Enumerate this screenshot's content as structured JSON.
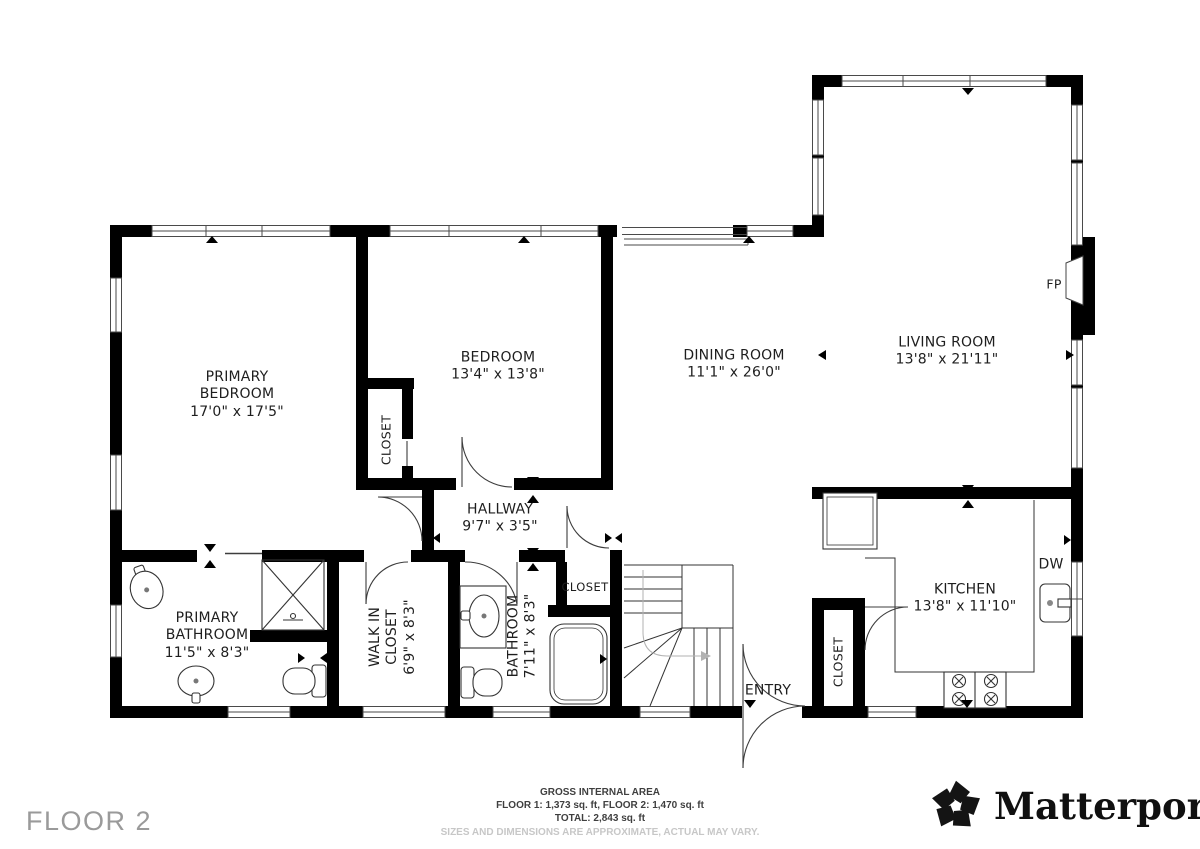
{
  "page": {
    "floor_label": "FLOOR 2"
  },
  "rooms": [
    {
      "name": "PRIMARY BEDROOM",
      "dims": "17'0\" x 17'5\""
    },
    {
      "name": "BEDROOM",
      "dims": "13'4\" x 13'8\""
    },
    {
      "name": "DINING ROOM",
      "dims": "11'1\" x 26'0\""
    },
    {
      "name": "LIVING ROOM",
      "dims": "13'8\" x 21'11\""
    },
    {
      "name": "HALLWAY",
      "dims": "9'7\" x 3'5\""
    },
    {
      "name": "PRIMARY BATHROOM",
      "dims": "11'5\" x 8'3\""
    },
    {
      "name": "WALK IN CLOSET",
      "dims": "6'9\" x 8'3\""
    },
    {
      "name": "BATHROOM",
      "dims": "7'11\" x 8'3\""
    },
    {
      "name": "KITCHEN",
      "dims": "13'8\" x 11'10\""
    }
  ],
  "closets": {
    "bedroom": "CLOSET",
    "hallway": "CLOSET",
    "kitchen": "CLOSET"
  },
  "annotations": {
    "entry": "ENTRY",
    "fireplace_abbr": "FP",
    "dishwasher_abbr": "DW"
  },
  "footer": {
    "line1": "GROSS INTERNAL AREA",
    "line2": "FLOOR 1: 1,373 sq. ft, FLOOR 2: 1,470 sq. ft",
    "line3": "TOTAL: 2,843 sq. ft",
    "disclaimer": "SIZES AND DIMENSIONS ARE APPROXIMATE, ACTUAL MAY VARY."
  },
  "brand": {
    "name": "Matterport",
    "registered_mark": "®"
  },
  "colors": {
    "wall": "#000000",
    "line": "#3d3d3d",
    "muted": "#9a9a9a",
    "disclaimer": "#c7c7c7"
  }
}
